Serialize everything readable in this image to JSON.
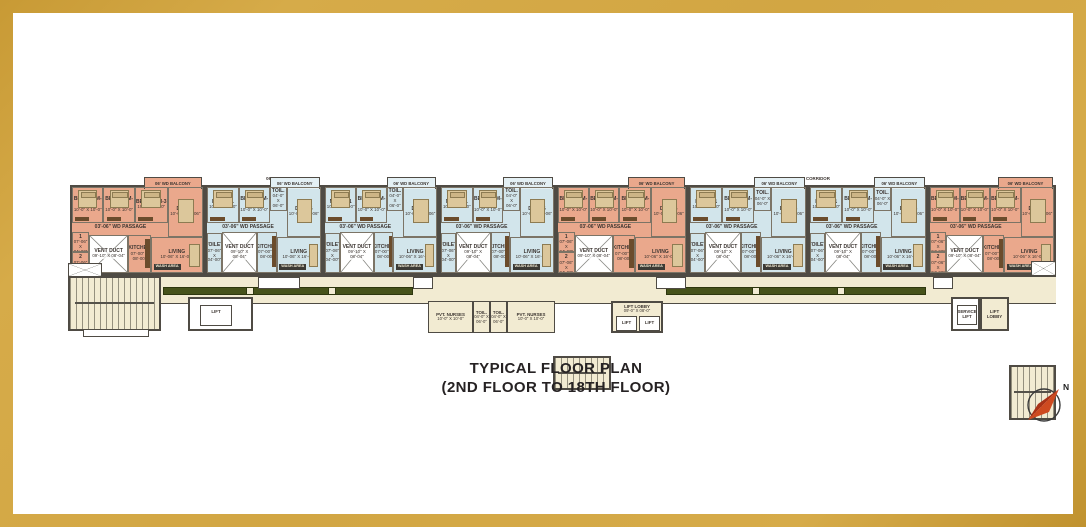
{
  "title": {
    "line1": "TYPICAL FLOOR PLAN",
    "line2": "(2ND FLOOR TO 18TH FLOOR)"
  },
  "compass": {
    "north_label": "N"
  },
  "colors": {
    "frame_gold": "#d2a643",
    "unit_salmon": "#eaa88c",
    "unit_blue": "#d2e5eb",
    "corridor_cream": "#f2ebd2",
    "corridor_band_olive": "#47531b",
    "wall_gray": "#4f4b44",
    "compass_red": "#c23b16"
  },
  "corridor": {
    "label": "06' WIDE CORRIDOR"
  },
  "unit_types": {
    "salmon": {
      "bedroom1": {
        "name": "BEDROOM-1",
        "dim": "10'-0\" X 10'-0\""
      },
      "bedroom2": {
        "name": "BEDROOM-2",
        "dim": "10'-0\" X 10'-0\""
      },
      "bedroom3": {
        "name": "BEDROOM-3",
        "dim": "10'-0\" X 10'-0\""
      },
      "dining": {
        "name": "DINING",
        "dim": "10'-0\" X 09'-06\""
      },
      "passage": {
        "name": "03'-06\" WD PASSAGE"
      },
      "toilet1": {
        "name": "TOILET 1",
        "dim": "07'-06\" X 04'-00\""
      },
      "toilet2": {
        "name": "TOILET 2",
        "dim": "07'-06\" X 04'-00\""
      },
      "vent": {
        "name": "VENT DUCT",
        "dim": "09'-10\" X 08'-04\""
      },
      "kitchen": {
        "name": "KITCHEN",
        "dim": "07'-00\" X 08'-00\""
      },
      "living": {
        "name": "LIVING",
        "dim": "10'-06\" X 16'-06\""
      },
      "wash": {
        "name": "WASH AREA"
      },
      "balcony": {
        "name": "06' WD BALCONY"
      }
    },
    "blue": {
      "mbed": {
        "name": "M. BED-1",
        "dim": "10'-0\" X 10'-0\""
      },
      "bedroom2": {
        "name": "BEDROOM-2",
        "dim": "10'-0\" X 10'-0\""
      },
      "toil": {
        "name": "TOIL.",
        "dim": "04'-0\" X 06'-0\""
      },
      "dining": {
        "name": "DINING",
        "dim": "10'-0\" X 09'-06\""
      },
      "passage": {
        "name": "03'-06\" WD PASSAGE"
      },
      "toilet": {
        "name": "TOILET",
        "dim": "07'-06\" X 04'-00\""
      },
      "vent": {
        "name": "VENT DUCT",
        "dim": "09'-10\" X 08'-04\""
      },
      "kitchen": {
        "name": "KITCHEN",
        "dim": "07'-00\" X 08'-00\""
      },
      "living": {
        "name": "LIVING",
        "dim": "10'-06\" X 16'-06\""
      },
      "wash": {
        "name": "WASH AREA"
      },
      "balcony": {
        "name": "06' WD BALCONY"
      }
    }
  },
  "facilities": {
    "nurses": {
      "name": "PVT. NURSES",
      "dim": "10'-0\" X 10'-0\""
    },
    "toil_small": {
      "name": "TOIL.",
      "dim": "04'-0\" X 06'-0\""
    },
    "lift_lobby": {
      "name": "LIFT LOBBY",
      "dim": "09'-0\" X 08'-0\""
    },
    "lift": {
      "name": "LIFT"
    },
    "service_lift": {
      "name": "SERVICE LIFT"
    },
    "right_lobby": {
      "name": "LIFT LOBBY"
    }
  }
}
